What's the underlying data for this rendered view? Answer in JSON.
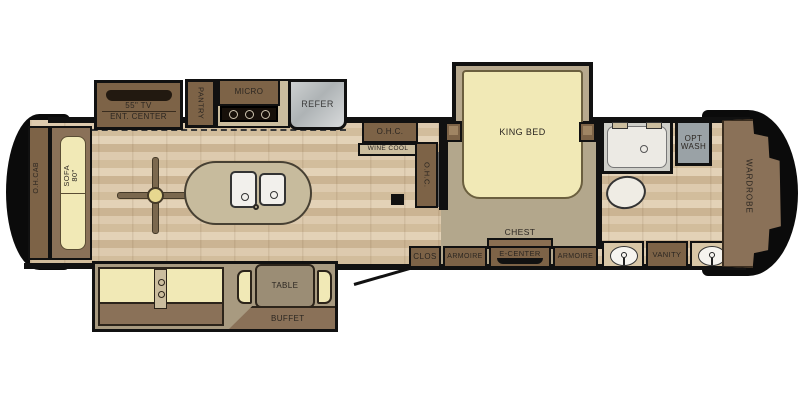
{
  "colors": {
    "outline": "#111111",
    "cabinet": "#7d6347",
    "cabinet-light": "#cbbd9e",
    "cushion": "#f1e9b6",
    "floor-light": "#ddcaae",
    "floor-dark": "#cbb493",
    "carpet": "#b3a78c",
    "island": "#c7bb9d",
    "appliance": "#aeb3b5",
    "label": "#2b2621"
  },
  "front_lounge": {
    "overhead_cabinet": "O.H.CAB",
    "sofa": "SOFA",
    "sofa_size": "80\""
  },
  "kitchen": {
    "tv": "55\" TV",
    "entertainment_center": "ENT. CENTER",
    "pantry": "PANTRY",
    "microwave": "MICRO",
    "refrigerator": "REFER",
    "overhead_cabinet": "O.H.C.",
    "wine_cooler": "WINE COOL",
    "overhead_cabinet_side": "O.H.C."
  },
  "bedroom": {
    "bed": "KING BED",
    "chest": "CHEST",
    "entertainment_center": "E-CENTER",
    "armoire_left": "ARMOIRE",
    "armoire_right": "ARMOIRE",
    "closet": "CLOS"
  },
  "bathroom": {
    "optional_washer_line1": "OPT",
    "optional_washer_line2": "WASH",
    "vanity": "VANITY",
    "wardrobe": "WARDROBE"
  },
  "living_slide": {
    "table": "TABLE",
    "buffet": "BUFFET"
  }
}
